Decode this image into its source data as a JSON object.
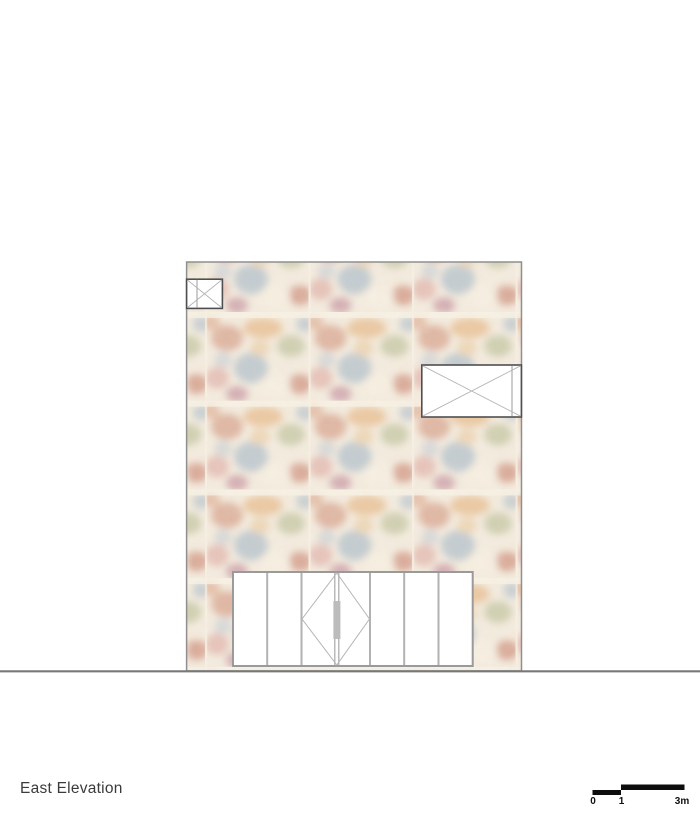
{
  "title": {
    "text": "East Elevation"
  },
  "scale_bar": {
    "labels": [
      "0",
      "1",
      "3m"
    ],
    "color": "#0d0d0d"
  },
  "colors": {
    "background": "#ffffff",
    "facade_outline": "#8f8f8f",
    "window_frame": "#4f4f4f",
    "glass": "#ffffff",
    "glazing_line": "#b5b5b5",
    "divider_line": "#9b9b9b",
    "door_frame": "#9a9a9a",
    "door_mullion": "#b2b2b2",
    "door_stile": "#a8a8a8",
    "door_handle": "#bcbcbc",
    "ground_line": "#787878",
    "title_text": "#3b3b3b",
    "texture_base": "#f3ecdf",
    "texture_seam": "#f8f2e6"
  },
  "texture": {
    "palette": [
      "#cf8e76",
      "#e3ad74",
      "#9db3c6",
      "#b4ba90",
      "#c67a66",
      "#dba49e",
      "#f8f2e4",
      "#bb7f93",
      "#d9a386",
      "#a9bac9",
      "#e8c79a",
      "#c2cbd4"
    ]
  }
}
